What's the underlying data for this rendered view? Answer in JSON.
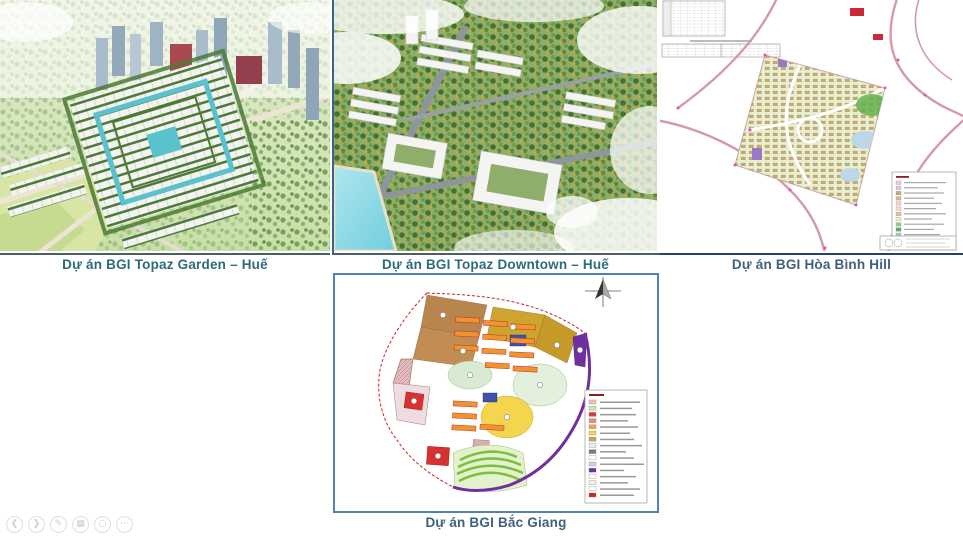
{
  "slide": {
    "projects": [
      {
        "caption": "Dự án BGI Topaz Garden – Huế"
      },
      {
        "caption": "Dự án BGI Topaz Downtown – Huế"
      },
      {
        "caption": "Dự án BGI  Hòa Bình Hill"
      },
      {
        "caption": "Dự án BGI Bắc Giang"
      }
    ]
  },
  "colors": {
    "caption_teal": "#2e6b78",
    "caption_slate": "#3f617e",
    "frame_blue": "#4f81bd",
    "water_teal": "#59c2cc",
    "canopy_green": "#8fae6b",
    "plan_road_pink": "#d49aa8",
    "boundary_purple": "#7030a0",
    "boundary_red": "#d02020"
  },
  "toolbar": {
    "icons": [
      {
        "name": "previous-slide",
        "glyph": "❮"
      },
      {
        "name": "next-slide",
        "glyph": "❯"
      },
      {
        "name": "pen-annotate",
        "glyph": "✎"
      },
      {
        "name": "all-slides-grid",
        "glyph": "▦"
      },
      {
        "name": "zoom-magnifier",
        "glyph": "○"
      },
      {
        "name": "more-options",
        "glyph": "⋯"
      }
    ]
  },
  "map_legends": {
    "hoa_binh_hill": {
      "swatches": [
        "#f2c7de",
        "#e3c7f2",
        "#caa97e",
        "#d9b98f",
        "#f2cfc7",
        "#f5ddc7",
        "#d9c7a0",
        "#f5eccf",
        "#8fd08f",
        "#5fb05f",
        "#9fd0b5",
        "#b59fd9"
      ]
    },
    "bac_giang": {
      "swatches": [
        "#eac3b5",
        "#d2e2b5",
        "#df3a3a",
        "#ee8585",
        "#f2a544",
        "#f5d44f",
        "#cba15e",
        "#ececec",
        "#7a7a7a",
        "#ffffff",
        "#c9d2f2",
        "#7030a0",
        "#ffffff",
        "#f2f2ea",
        "#ffffff",
        "#d02020"
      ]
    }
  }
}
